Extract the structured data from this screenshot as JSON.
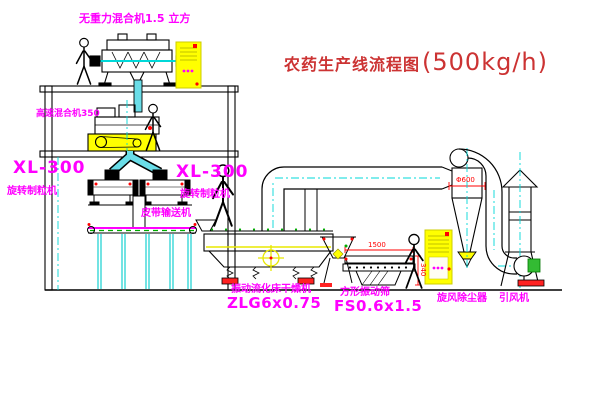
{
  "title": {
    "name": "农药生产线流程图",
    "capacity": "(500kg/h)"
  },
  "labels": {
    "gravity_mixer": "无重力混合机1.5 立方",
    "high_speed_mixer": "高速混合机350",
    "granulator_left_model": "XL-300",
    "granulator_left_name": "旋转制粒机",
    "granulator_right_model": "XL-300",
    "granulator_right_name": "旋转制粒机",
    "belt_conveyor": "皮带输送机",
    "dryer_name": "振动流化床干燥机",
    "dryer_model": "ZLG6x0.75",
    "screen_name": "方形振动筛",
    "screen_model": "FS0.6x1.5",
    "cyclone_name": "旋风除尘器",
    "fan_name": "引风机"
  },
  "dimensions": {
    "screen_length": "1500",
    "screen_height": "340",
    "cyclone_diameter": "Φ600"
  },
  "colors": {
    "label_magenta": "#ff00ff",
    "title_red": "#cc3333",
    "dimension_red": "#ff0000",
    "line_black": "#000000",
    "centerline_cyan": "#00d8d8",
    "cabinet_yellow": "#ffff00",
    "belt_green": "#00aa00"
  }
}
